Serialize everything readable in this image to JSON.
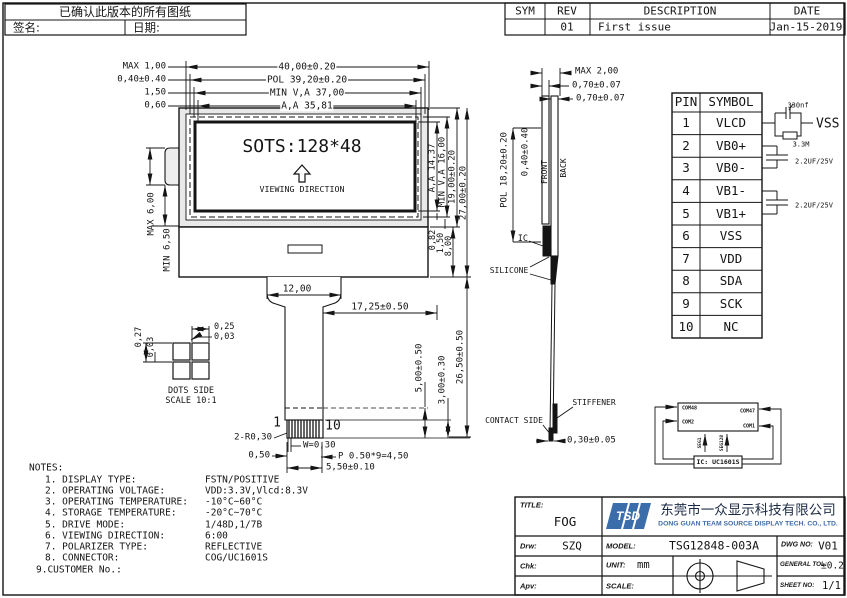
{
  "confirm_box": {
    "title": "已确认此版本的所有图纸",
    "sign_label": "签名:",
    "date_label": "日期:"
  },
  "rev_table": {
    "headers": [
      "SYM",
      "REV",
      "DESCRIPTION",
      "DATE"
    ],
    "row": [
      "",
      "01",
      "First issue",
      "Jan-15-2019"
    ]
  },
  "front": {
    "screen_text": "SOTS:128*48",
    "viewing_direction": "VIEWING DIRECTION",
    "dim_max100": "MAX 1,00",
    "dim_040": "0,40±0.40",
    "dim_150": "1,50",
    "dim_060": "0,60",
    "dim_w40": "40,00±0.20",
    "dim_pol_w": "POL 39,20±0.20",
    "dim_minva_w": "MIN V,A 37,00",
    "dim_aa_w": "A,A 35,81",
    "dim_max6": "MAX 6,00",
    "dim_min65": "MIN 6,50",
    "dim_aa_h": "A,A 14,37",
    "dim_minva_h": "MIN V,A 16,00",
    "dim_19": "19,00±0.20",
    "dim_27": "27,00±0.20",
    "dim_082": "0,82",
    "dim_150b": "1,50",
    "dim_800": "8,00",
    "dim_12": "12,00",
    "dim_1725": "17,25±0.50",
    "dim_2650": "26,50±0.50",
    "dim_500": "5,00±0.50",
    "dim_300": "3,00±0.30",
    "pin_first": "1",
    "pin_last": "10",
    "dim_r030": "2-R0,30",
    "dim_w030": "W=0,30",
    "dim_050": "0,50",
    "dim_pitch": "P 0.50*9=4,50",
    "dim_550": "5,50±0.10"
  },
  "dots_detail": {
    "dim_025": "0,25",
    "dim_003_top": "0,03",
    "dim_027": "0,27",
    "dim_003_left": "0,03",
    "caption1": "DOTS SIDE",
    "caption2": "SCALE 10:1"
  },
  "side": {
    "dim_max2": "MAX 2,00",
    "dim_070a": "0,70±0.07",
    "dim_070b": "0,70±0.07",
    "dim_pol_h": "POL 18,20±0.20",
    "dim_040": "0,40±0.40",
    "front_label": "FRONT",
    "back_label": "BACK",
    "ic_label": "IC",
    "silicone_label": "SILICONE",
    "stiffener_label": "STIFFENER",
    "contact_label": "CONTACT SIDE",
    "dim_030": "0,30±0.05"
  },
  "pin_table": {
    "h_pin": "PIN",
    "h_sym": "SYMBOL",
    "rows": [
      [
        "1",
        "VLCD"
      ],
      [
        "2",
        "VB0+"
      ],
      [
        "3",
        "VB0-"
      ],
      [
        "4",
        "VB1-"
      ],
      [
        "5",
        "VB1+"
      ],
      [
        "6",
        "VSS"
      ],
      [
        "7",
        "VDD"
      ],
      [
        "8",
        "SDA"
      ],
      [
        "9",
        "SCK"
      ],
      [
        "10",
        "NC"
      ]
    ]
  },
  "circuit": {
    "cap330": "330nf",
    "vss": "VSS",
    "res33m": "3.3M",
    "cap1": "2.2UF/25V",
    "cap2": "2.2UF/25V"
  },
  "com_diagram": {
    "com48": "COM48",
    "com47": "COM47",
    "com2": "COM2",
    "com1": "COM1",
    "seg1": "SEG1",
    "seg128": "SEG128",
    "ic": "IC: UC1601S"
  },
  "notes": {
    "title": "NOTES:",
    "items": [
      [
        "1. DISPLAY TYPE:",
        "FSTN/POSITIVE"
      ],
      [
        "2. OPERATING VOLTAGE:",
        "VDD:3.3V,Vlcd:8.3V"
      ],
      [
        "3. OPERATING TEMPERATURE:",
        "-10°C~60°C"
      ],
      [
        "4. STORAGE TEMPERATURE:",
        "-20°C~70°C"
      ],
      [
        "5. DRIVE MODE:",
        "1/48D,1/7B"
      ],
      [
        "6. VIEWING DIRECTION:",
        "6:00"
      ],
      [
        "7. POLARIZER TYPE:",
        "REFLECTIVE"
      ],
      [
        "8. CONNECTOR:",
        "COG/UC1601S"
      ],
      [
        "9.CUSTOMER No.:",
        ""
      ]
    ]
  },
  "title_block": {
    "title_label": "TITLE:",
    "title": "FOG",
    "logo_text": "TSD",
    "company_cn": "东莞市一众显示科技有限公司",
    "company_en": "DONG GUAN TEAM SOURCE DISPLAY TECH. CO., LTD.",
    "drw_label": "Drw:",
    "drw": "SZQ",
    "model_label": "MODEL:",
    "model": "TSG12848-003A",
    "dwg_label": "DWG NO:",
    "dwg": "V01",
    "chk_label": "Chk:",
    "unit_label": "UNIT:",
    "unit": "mm",
    "tol_label": "GENERAL TOL:",
    "tol": "±0.2",
    "apv_label": "Apv:",
    "scale_label": "SCALE:",
    "sheet_label": "SHEET NO:",
    "sheet": "1/1"
  }
}
